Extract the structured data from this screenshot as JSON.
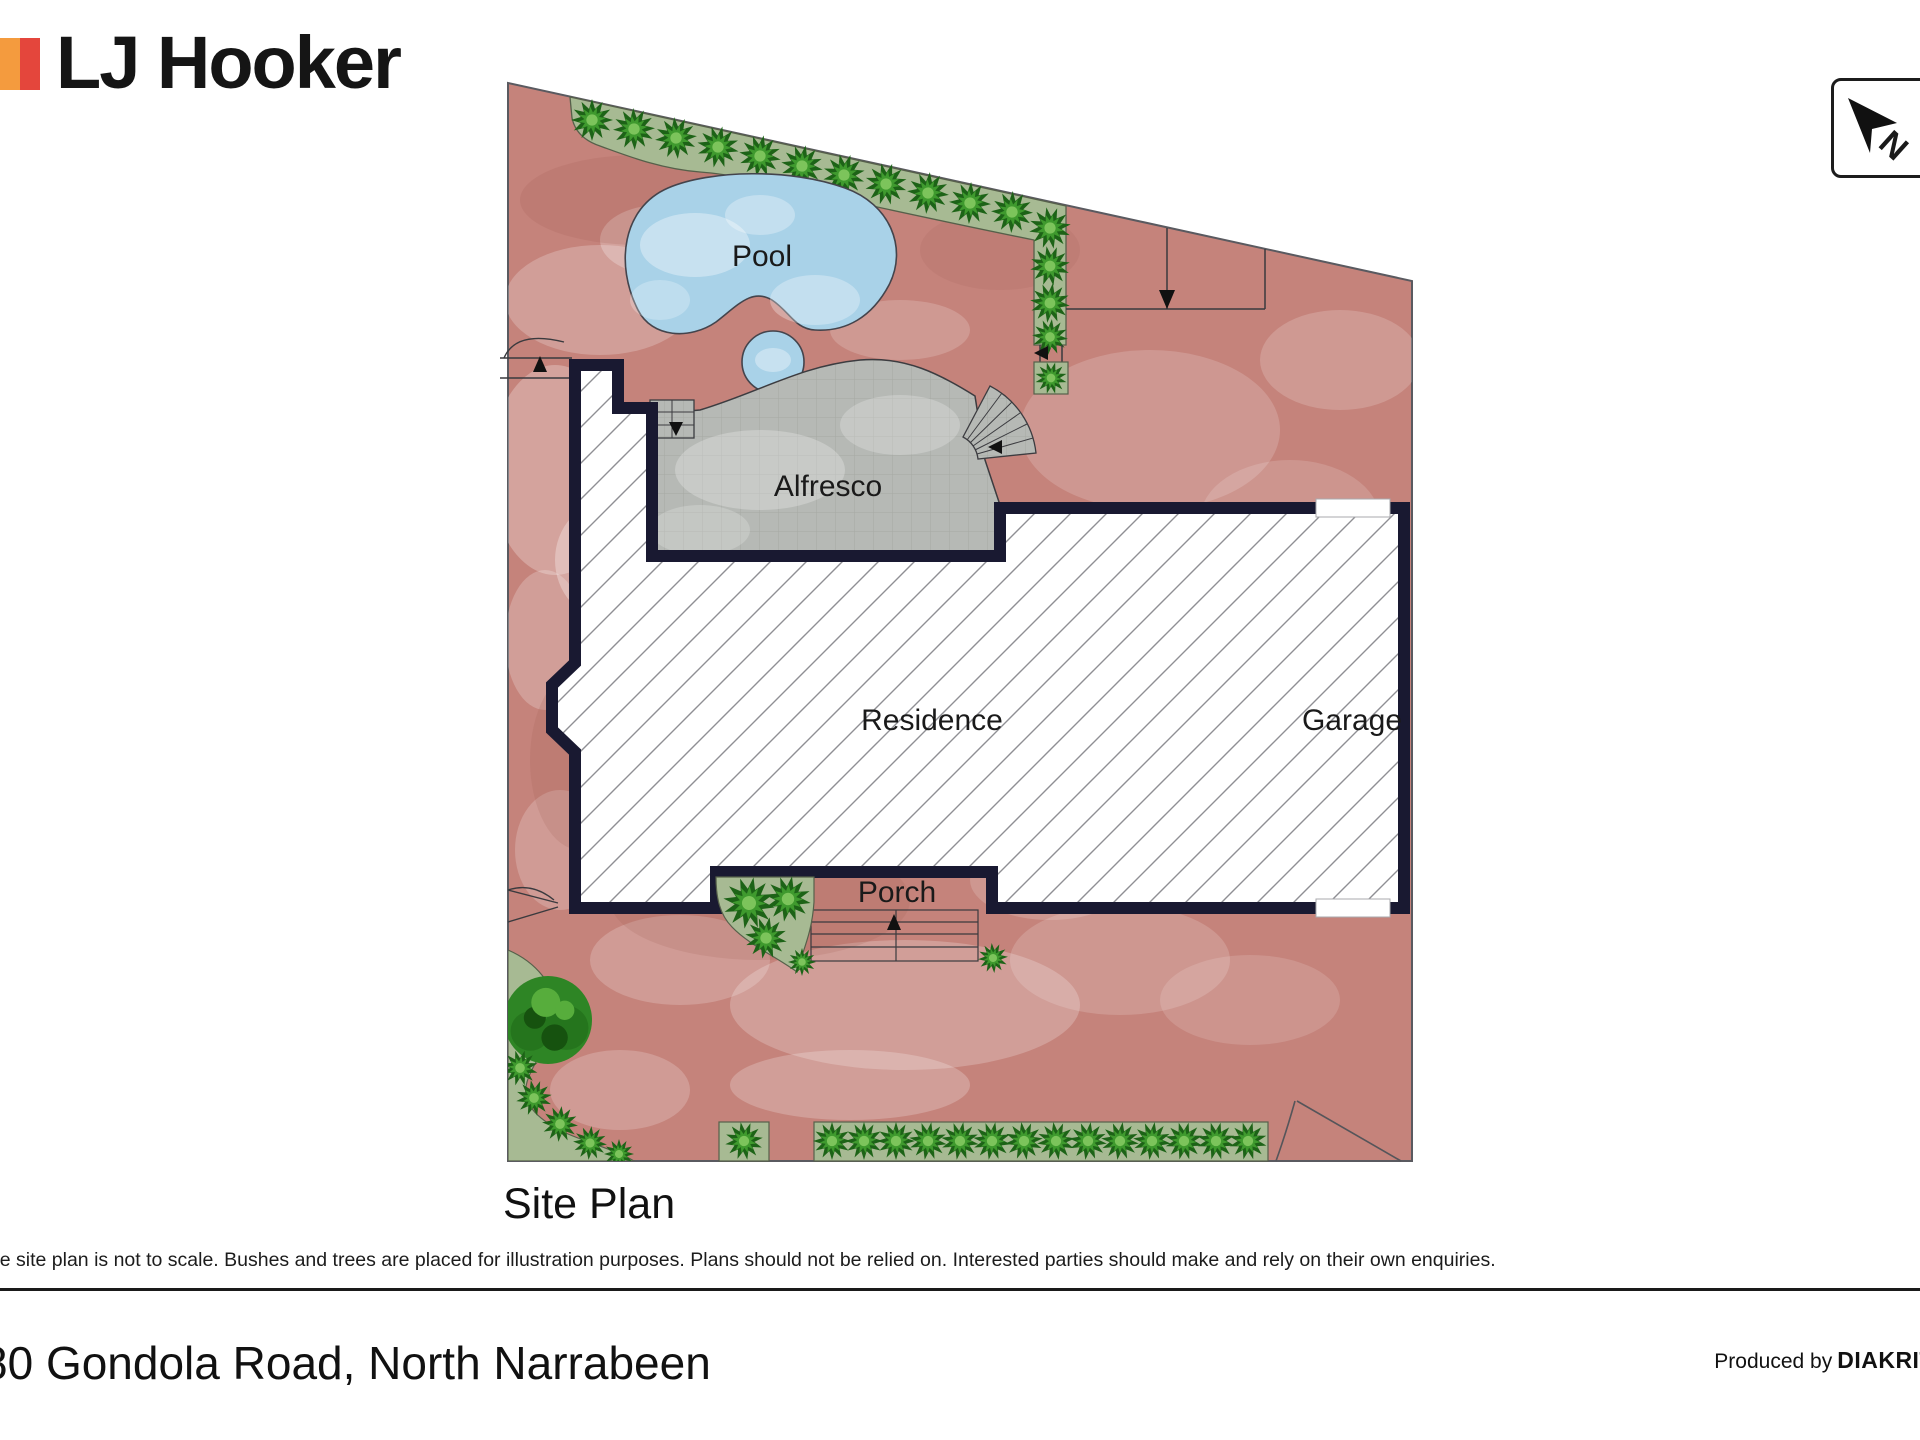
{
  "brand": {
    "name": "LJ Hooker",
    "bar_color_left": "#F49B3E",
    "bar_color_right": "#E4463C"
  },
  "compass": {
    "label": "N",
    "icon": "navigation-arrow-northwest"
  },
  "plan": {
    "title": "Site Plan",
    "labels": {
      "pool": "Pool",
      "alfresco": "Alfresco",
      "residence": "Residence",
      "garage": "Garage",
      "porch": "Porch"
    },
    "colors": {
      "ground": "#c5837b",
      "hedge": "#a7ba93",
      "bush_dark": "#1d6317",
      "bush_mid": "#3f9a2e",
      "bush_light": "#7cc45b",
      "pool_water": "#a9d2e8",
      "paving": "#b6b9b5",
      "wall": "#191931",
      "hatch_line": "#8f8f94",
      "boundary": "#5a5a60"
    },
    "icons": {
      "bush": "shrub",
      "tree": "tree",
      "arrows": "entry-direction-arrows"
    }
  },
  "disclaimer": "The site plan is not to scale. Bushes and trees are placed for illustration purposes. Plans should not be relied on. Interested parties should make and rely on their own enquiries.",
  "footer": {
    "address": "80 Gondola Road, North Narrabeen",
    "produced_by_label": "Produced by",
    "producer": "DIAKRIT"
  }
}
